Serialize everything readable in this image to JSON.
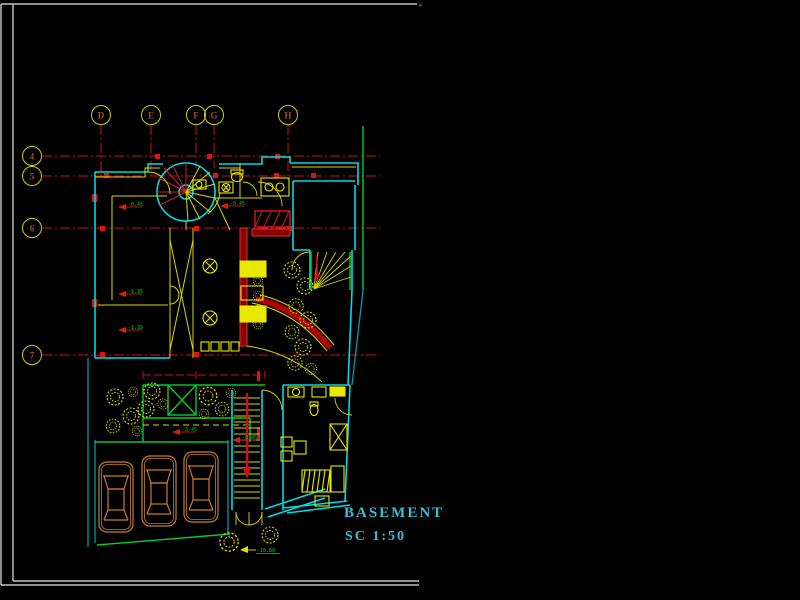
{
  "title_block": {
    "title": "BASEMENT",
    "scale": "SC 1:50"
  },
  "frame": {
    "corner_mark": "×"
  },
  "grid": {
    "columns": [
      {
        "label": "D"
      },
      {
        "label": "E"
      },
      {
        "label": "F"
      },
      {
        "label": "G"
      },
      {
        "label": "H"
      }
    ],
    "rows": [
      {
        "label": "4"
      },
      {
        "label": "5"
      },
      {
        "label": "6"
      },
      {
        "label": "7"
      }
    ]
  },
  "levels": [
    {
      "value": "-0.45"
    },
    {
      "value": "-0.45"
    },
    {
      "value": "-1.35"
    },
    {
      "value": "-1.35"
    },
    {
      "value": "-3.45"
    },
    {
      "value": "-0.45"
    },
    {
      "value": "-10.80"
    }
  ],
  "colors": {
    "background": "#000000",
    "frame_white": "#e8e8e8",
    "wall_cyan": "#00d9e8",
    "site_teal": "#009aa8",
    "grid_red": "#c81414",
    "dark_red_fill": "#8a0000",
    "accent_yellow": "#e8e800",
    "site_green": "#00cc33",
    "car_brown": "#c97c2f",
    "title_cyan": "#38bfd3",
    "level_green": "#00d800",
    "bubble_text_brown": "#a34f1f"
  }
}
